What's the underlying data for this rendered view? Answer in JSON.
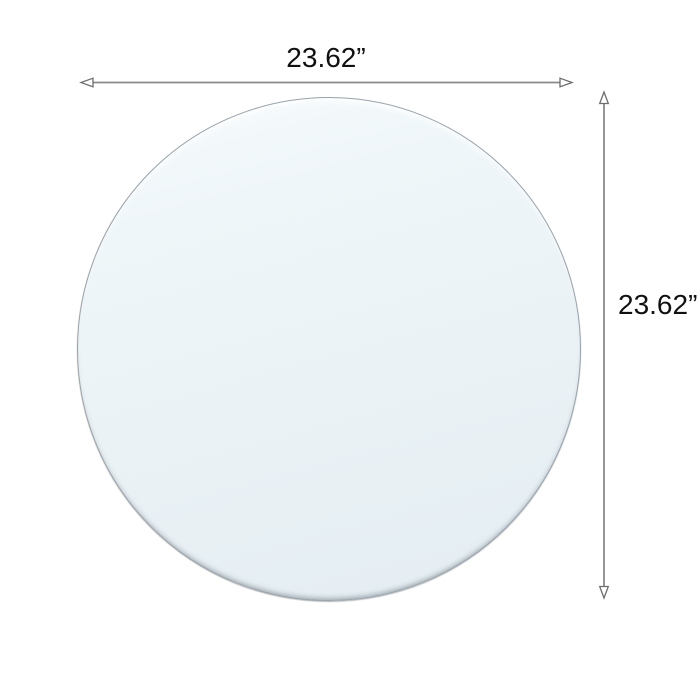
{
  "diagram": {
    "type": "product-dimension-diagram",
    "background_color": "#ffffff"
  },
  "product": {
    "name": "round glass tabletop",
    "fill_color_top": "#f8fcfd",
    "fill_color_bottom": "#e4edf2",
    "edge_color": "#9aa2aa"
  },
  "dimensions": {
    "width": {
      "label": "23.62”"
    },
    "height": {
      "label": "23.62”"
    }
  },
  "style": {
    "dimension_line_color": "#8a8a8a",
    "arrowhead_outline_color": "#6e6e6e",
    "text_color": "#111111"
  }
}
